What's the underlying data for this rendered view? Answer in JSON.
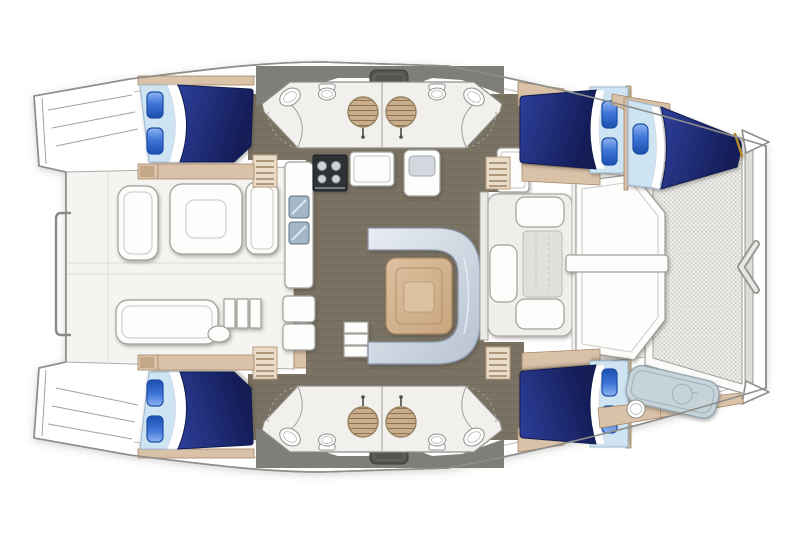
{
  "meta": {
    "title": "Catamaran accommodation floor plan"
  },
  "palette": {
    "outline": "#8f8e8a",
    "innerline": "#bcbbb7",
    "deck_band": "#807e79",
    "hatch": "#55544f",
    "floor": "#7a7263",
    "floor_line": "#645c4d",
    "teak": "#d9c2a8",
    "teak_stroke": "#a58766",
    "sheet": "#cfe4f2",
    "sheet_stroke": "#9cb8cc",
    "pillow_stroke": "#1a4da6",
    "duvet_stroke": "#101a4e",
    "sofa_stroke": "#8794a6",
    "wood_stroke": "#a5855f",
    "glass": "#a9c3d6",
    "steel": "#a3b7c6",
    "stove": "#2d3036",
    "pad": "#c6d3d9",
    "pad_stroke": "#8da0a9",
    "gold": "#b5892f",
    "deck_white": "#f6f5f2",
    "sole": "#f5f4f1",
    "duvet_navy": "#1c2a75",
    "pillow_blue": "#2f6cd0",
    "mesh_bg": "#ecebe8",
    "mesh_dot": "#c3c2be"
  },
  "rooms": {
    "hull": {
      "label": "catamaran hull outline"
    },
    "cockpit": {
      "label": "aft cockpit with seating and table"
    },
    "saloon": {
      "label": "saloon with C-shaped sofa and table"
    },
    "galley": {
      "label": "galley with stove, double sink and counters"
    },
    "head_port_aft": {
      "label": "port aft head with shower, basin and toilet"
    },
    "head_port_fwd": {
      "label": "port forward head with shower, basin and toilet"
    },
    "head_stbd_aft": {
      "label": "starboard aft head with shower, basin and toilet"
    },
    "head_stbd_fwd": {
      "label": "starboard forward head with shower, basin and toilet"
    },
    "cabin_port_aft": {
      "label": "port aft double cabin"
    },
    "cabin_stbd_aft": {
      "label": "starboard aft double cabin"
    },
    "cabin_port_fwd": {
      "label": "port forward double cabin"
    },
    "cabin_stbd_fwd": {
      "label": "starboard forward double cabin"
    },
    "forepeak_port": {
      "label": "port forepeak single berth"
    },
    "forepeak_stbd": {
      "label": "starboard forepeak crew berth pad"
    },
    "foredeck": {
      "label": "foredeck with anchor locker"
    },
    "trampoline": {
      "label": "bow trampoline net"
    },
    "transom_port": {
      "label": "port transom steps"
    },
    "transom_stbd": {
      "label": "starboard transom steps"
    }
  },
  "inventory": {
    "double_beds": 4,
    "single_berths": 2,
    "heads": 4,
    "round_showers": 4,
    "pillows_per_double_bed": 2,
    "cockpit_tables": 1,
    "saloon_tables": 1
  }
}
